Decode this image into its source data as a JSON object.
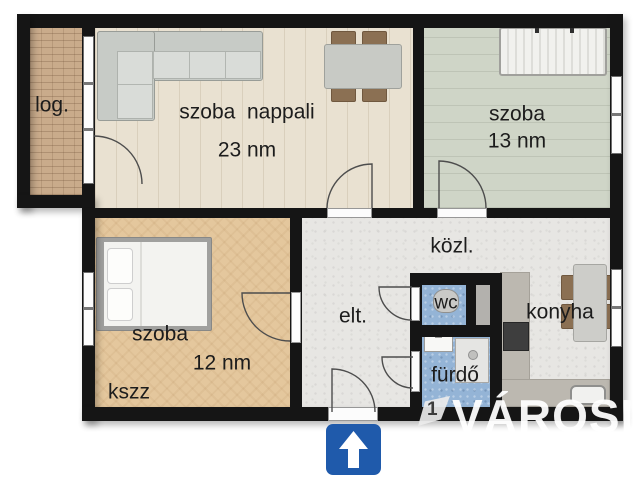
{
  "floorplan": {
    "rooms": {
      "loggia": {
        "label": "log."
      },
      "living": {
        "label": "szoba  nappali",
        "area": "23 nm"
      },
      "bedroom2": {
        "label": "szoba",
        "area": "13 nm"
      },
      "bedroom1": {
        "label": "szoba",
        "area": "12 nm"
      },
      "hall": {
        "label": "közl."
      },
      "entry": {
        "label": "elt."
      },
      "wc": {
        "label": "wc"
      },
      "bathroom": {
        "label": "fürdő"
      },
      "kitchen": {
        "label": "konyha"
      }
    },
    "corner_note": "kszz",
    "entrance_direction": "up"
  },
  "watermark": {
    "logo_glyph": "1",
    "text": "VÁROSI"
  },
  "colors": {
    "wall": "#151515",
    "living_floor": "#e9e1d1",
    "bedroom2_floor": "#cfd5c7",
    "bedroom1_floor": "#e4c79d",
    "hall_floor": "#e7e6e3",
    "wet_room_floor": "#94b4d6",
    "loggia_floor": "#c9ab8b",
    "kitchen_counter": "#bcb8b0",
    "entrance_sign_blue": "#1f5aab"
  }
}
